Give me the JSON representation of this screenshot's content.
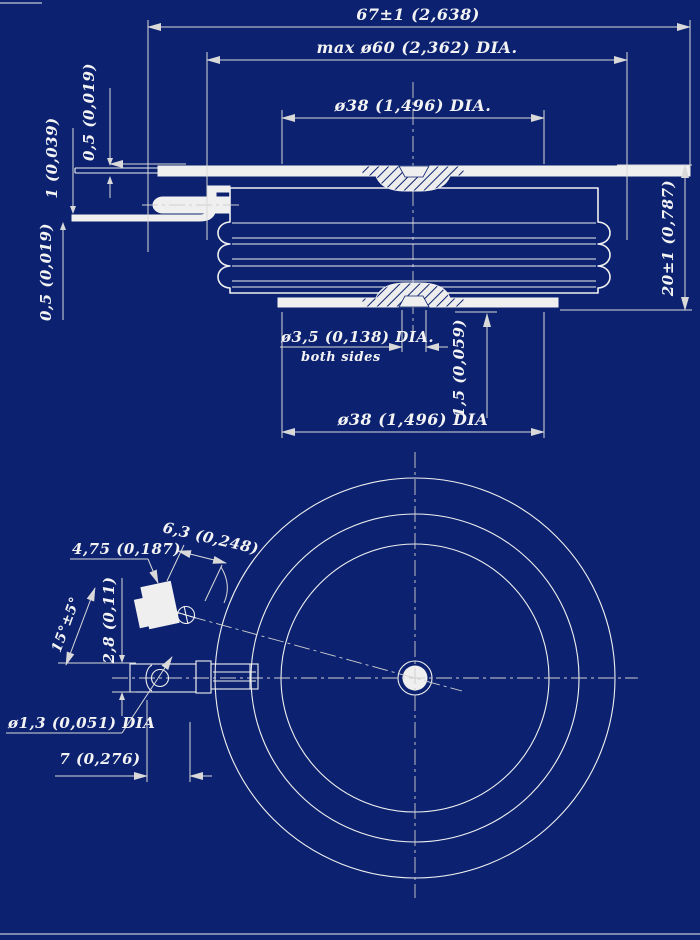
{
  "drawing": {
    "background_color": "#0c2270",
    "line_color": "#f0f0f0",
    "dim_line_color": "#d9d9d9",
    "side_view": {
      "overall_width_dim": "67±1 (2,638)",
      "max_diameter_dim": "max ø60 (2,362) DIA.",
      "pole_face_dia_top_dim": "ø38 (1,496) DIA.",
      "pole_face_dia_bottom_dim": "ø38 (1,496) DIA",
      "lead_thickness_top_dim": "0,5 (0,019)",
      "terminal_thickness_dim": "1 (0,039)",
      "lead_thickness_bottom_dim": "0,5 (0,019)",
      "height_dim": "20±1 (0,787)",
      "center_hole_dia_dim": "ø3,5 (0,138) DIA.",
      "center_hole_note": "both sides",
      "recess_depth_dim": "1,5 (0,059)"
    },
    "plan_view": {
      "tab_width_dim": "6,3 (0,248)",
      "tab_length_dim": "4,75 (0,187)",
      "lead_angle_dim": "15°±5°",
      "terminal_thickness_dim": "2,8 (0,11)",
      "gate_wire_dia_dim": "ø1,3 (0,051) DIA",
      "wire_length_dim": "7 (0,276)"
    }
  }
}
